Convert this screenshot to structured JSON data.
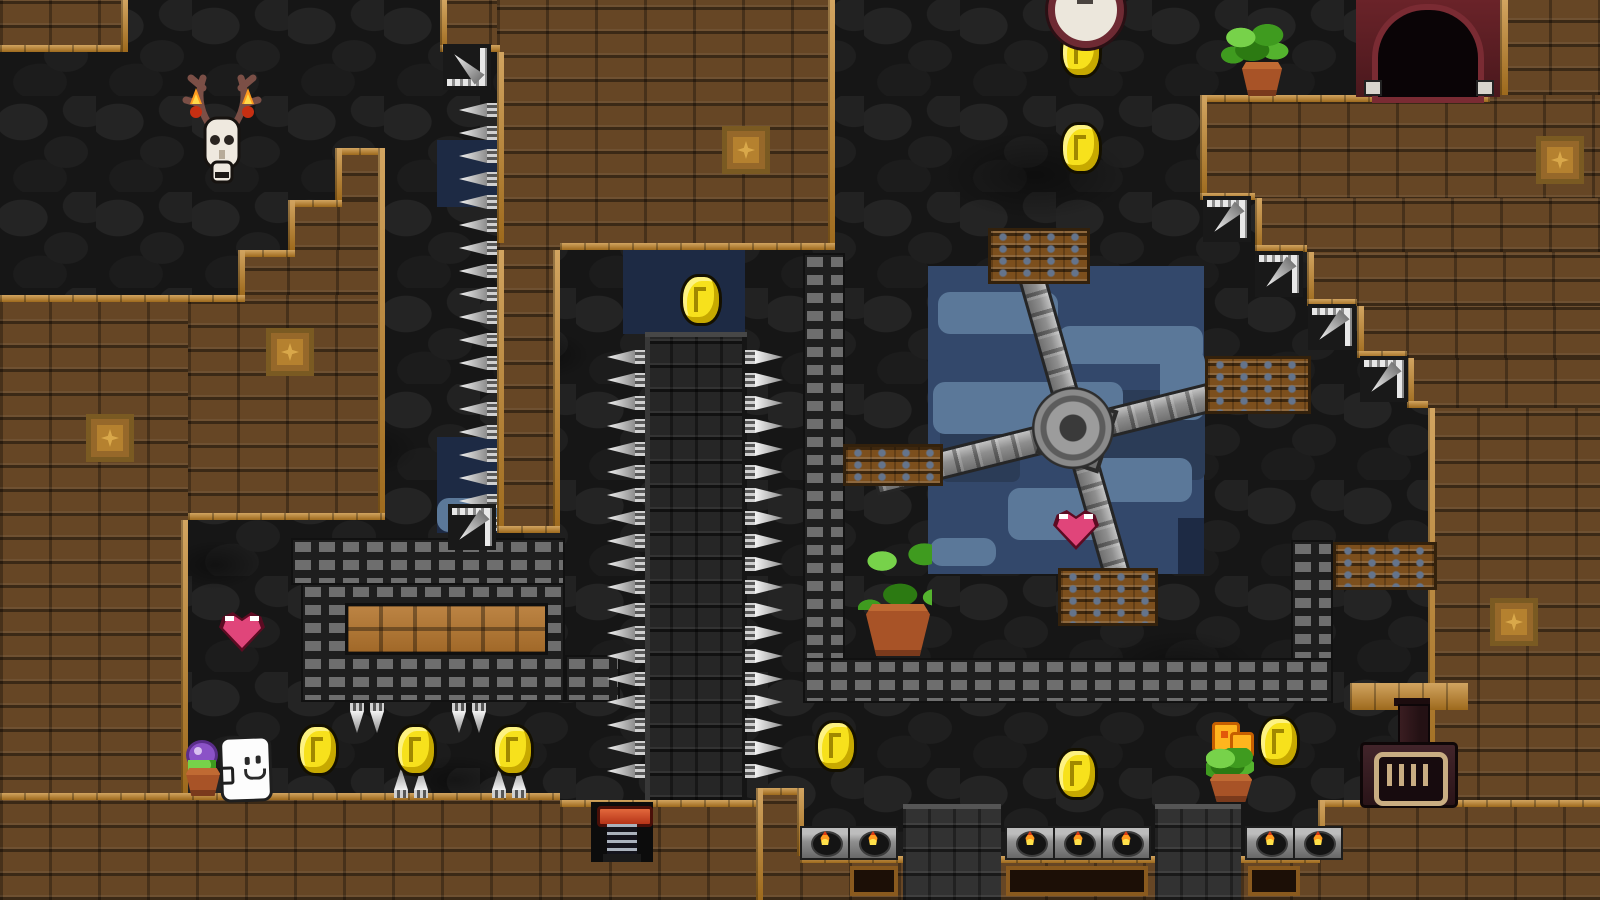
{
  "meta": {
    "description": "Pixel-art platformer cave level screenshot",
    "width": 1600,
    "height": 900,
    "visible_text": ""
  },
  "palette": {
    "cave_bg": "#161616",
    "cave_stone": "#242424",
    "brick_interior": "#664625",
    "brick_edge_orange": "#c08123",
    "water_navy": "#1d2a44",
    "water_slate": "#33486b",
    "cloud_blue": "#5b7899",
    "metal_stud": "#6e6e6e",
    "spike_white": "#f4f4f4",
    "coin_yellow": "#f7e11c",
    "heart_pink": "#e0457a",
    "crate_wood": "#7c4f1d",
    "crate_bolt_blue": "#64748c",
    "flame_orange": "#ff9b1f",
    "flame_yellow": "#ffe14a",
    "pot_terracotta": "#a85327",
    "plant_green": "#3f9b1f",
    "doorway_maroon": "#5d2026",
    "ghost_white": "#fdfdfd"
  },
  "scene": {
    "smudges": [
      [
        110,
        320,
        170,
        90
      ],
      [
        620,
        110,
        130,
        70
      ],
      [
        940,
        130,
        190,
        90
      ],
      [
        290,
        420,
        130,
        60
      ],
      [
        1100,
        630,
        160,
        80
      ],
      [
        400,
        755,
        110,
        50
      ],
      [
        500,
        330,
        90,
        50
      ],
      [
        170,
        540,
        90,
        50
      ]
    ],
    "blue_patches": [
      {
        "r": [
          437,
          140,
          60,
          67
        ],
        "k": "navy"
      },
      {
        "r": [
          437,
          437,
          60,
          96
        ],
        "k": "navy"
      },
      {
        "r": [
          623,
          250,
          122,
          84
        ],
        "k": "navy"
      },
      {
        "r": [
          928,
          266,
          276,
          308
        ],
        "k": "slate"
      },
      {
        "r": [
          1090,
          390,
          115,
          90
        ],
        "k": "deep"
      },
      {
        "r": [
          940,
          420,
          80,
          62
        ],
        "k": "deep"
      },
      {
        "r": [
          1178,
          296,
          26,
          62
        ],
        "k": "slate"
      },
      {
        "r": [
          1178,
          518,
          26,
          56
        ],
        "k": "navy"
      }
    ],
    "clouds": [
      [
        938,
        292,
        120,
        42
      ],
      [
        1058,
        326,
        145,
        38
      ],
      [
        933,
        382,
        190,
        52
      ],
      [
        1092,
        458,
        100,
        44
      ],
      [
        1008,
        488,
        96,
        52
      ],
      [
        930,
        538,
        66,
        28
      ],
      [
        1160,
        350,
        45,
        70
      ],
      [
        437,
        498,
        60,
        34
      ]
    ],
    "bricks": [
      [
        0,
        0,
        128,
        52
      ],
      [
        440,
        0,
        60,
        52
      ],
      [
        497,
        0,
        338,
        250
      ],
      [
        497,
        250,
        63,
        283
      ],
      [
        335,
        148,
        50,
        52
      ],
      [
        288,
        200,
        97,
        50
      ],
      [
        238,
        250,
        147,
        45
      ],
      [
        188,
        295,
        197,
        225
      ],
      [
        0,
        295,
        188,
        605
      ],
      [
        0,
        793,
        560,
        107
      ],
      [
        560,
        800,
        200,
        100
      ],
      [
        756,
        788,
        48,
        112
      ],
      [
        800,
        856,
        520,
        44
      ],
      [
        1318,
        800,
        282,
        100
      ],
      [
        1500,
        0,
        100,
        95
      ],
      [
        1200,
        95,
        400,
        105
      ],
      [
        1255,
        198,
        345,
        54
      ],
      [
        1307,
        252,
        293,
        54
      ],
      [
        1357,
        306,
        243,
        52
      ],
      [
        1407,
        358,
        193,
        50
      ],
      [
        1428,
        408,
        172,
        392
      ]
    ],
    "edges": [
      [
        0,
        45,
        128,
        7
      ],
      [
        121,
        0,
        7,
        52
      ],
      [
        440,
        0,
        7,
        52
      ],
      [
        440,
        45,
        60,
        7
      ],
      [
        828,
        0,
        7,
        250
      ],
      [
        560,
        243,
        275,
        7
      ],
      [
        497,
        52,
        7,
        191
      ],
      [
        497,
        250,
        7,
        283
      ],
      [
        553,
        250,
        7,
        283
      ],
      [
        497,
        526,
        63,
        7
      ],
      [
        335,
        148,
        50,
        7
      ],
      [
        335,
        148,
        7,
        52
      ],
      [
        288,
        200,
        54,
        7
      ],
      [
        288,
        200,
        7,
        50
      ],
      [
        238,
        250,
        57,
        7
      ],
      [
        238,
        250,
        7,
        45
      ],
      [
        188,
        295,
        57,
        7
      ],
      [
        378,
        148,
        7,
        372
      ],
      [
        188,
        513,
        197,
        7
      ],
      [
        0,
        295,
        188,
        7
      ],
      [
        181,
        520,
        7,
        273
      ],
      [
        0,
        793,
        560,
        7
      ],
      [
        560,
        800,
        200,
        7
      ],
      [
        756,
        788,
        48,
        7
      ],
      [
        756,
        788,
        7,
        112
      ],
      [
        797,
        788,
        7,
        68
      ],
      [
        800,
        856,
        520,
        7
      ],
      [
        1318,
        800,
        282,
        7
      ],
      [
        1318,
        800,
        7,
        56
      ],
      [
        1500,
        0,
        8,
        95
      ],
      [
        1200,
        95,
        290,
        7
      ],
      [
        1200,
        95,
        7,
        105
      ],
      [
        1200,
        193,
        55,
        7
      ],
      [
        1255,
        198,
        7,
        54
      ],
      [
        1255,
        245,
        52,
        7
      ],
      [
        1307,
        252,
        7,
        54
      ],
      [
        1307,
        299,
        50,
        7
      ],
      [
        1357,
        306,
        7,
        52
      ],
      [
        1357,
        351,
        50,
        7
      ],
      [
        1407,
        358,
        7,
        50
      ],
      [
        1407,
        401,
        21,
        7
      ],
      [
        1428,
        408,
        7,
        392
      ],
      [
        1350,
        683,
        118,
        27
      ]
    ],
    "decals": [
      [
        722,
        126
      ],
      [
        266,
        328
      ],
      [
        86,
        414
      ],
      [
        1490,
        598
      ],
      [
        1536,
        136
      ]
    ],
    "rails": [
      [
        803,
        253,
        42,
        450
      ],
      [
        803,
        658,
        530,
        45
      ],
      [
        1291,
        540,
        42,
        120
      ],
      [
        291,
        538,
        274,
        47
      ],
      [
        301,
        583,
        264,
        119
      ],
      [
        565,
        655,
        55,
        47
      ]
    ],
    "maze_inset": [
      345,
      603,
      203,
      52
    ],
    "column": [
      645,
      332,
      102,
      468
    ],
    "pillars": [
      [
        903,
        804,
        98,
        96
      ],
      [
        1155,
        804,
        86,
        96
      ]
    ],
    "crates": [
      [
        988,
        228,
        96,
        50
      ],
      [
        1205,
        356,
        100,
        52
      ],
      [
        843,
        444,
        94,
        36
      ],
      [
        1058,
        568,
        94,
        52
      ],
      [
        1333,
        542,
        98,
        42
      ]
    ],
    "drills": [
      {
        "x": 443,
        "y": 44,
        "o": "ul"
      },
      {
        "x": 448,
        "y": 504,
        "o": "dl"
      },
      {
        "x": 1203,
        "y": 196,
        "o": "dl"
      },
      {
        "x": 1255,
        "y": 251,
        "o": "dl"
      },
      {
        "x": 1308,
        "y": 304,
        "o": "dl"
      },
      {
        "x": 1360,
        "y": 356,
        "o": "dl"
      }
    ],
    "spike_rows": [
      {
        "dir": "left",
        "x": 459,
        "y": 103,
        "count": 19,
        "step": 23
      },
      {
        "dir": "left",
        "x": 607,
        "y": 350,
        "count": 19,
        "step": 23
      },
      {
        "dir": "right",
        "x": 745,
        "y": 350,
        "count": 19,
        "step": 23
      },
      {
        "dir": "down",
        "x": 350,
        "y": 703,
        "count": 2,
        "step": 20
      },
      {
        "dir": "down",
        "x": 452,
        "y": 703,
        "count": 2,
        "step": 20
      },
      {
        "dir": "up",
        "x": 394,
        "y": 768,
        "count": 2,
        "step": 20
      },
      {
        "dir": "up",
        "x": 492,
        "y": 768,
        "count": 2,
        "step": 20
      }
    ],
    "fire_blocks": [
      [
        800,
        826
      ],
      [
        848,
        826
      ],
      [
        1005,
        826
      ],
      [
        1053,
        826
      ],
      [
        1101,
        826
      ],
      [
        1245,
        826
      ],
      [
        1293,
        826
      ]
    ],
    "floor_insets": [
      [
        850,
        866,
        48,
        30
      ],
      [
        1006,
        866,
        142,
        30
      ],
      [
        1248,
        866,
        52,
        30
      ]
    ],
    "coins": [
      [
        1060,
        26
      ],
      [
        1060,
        122
      ],
      [
        680,
        274
      ],
      [
        297,
        724
      ],
      [
        395,
        724
      ],
      [
        492,
        724
      ],
      [
        815,
        720
      ],
      [
        1056,
        748
      ],
      [
        1258,
        716
      ]
    ],
    "hearts": [
      [
        219,
        612,
        46,
        40
      ],
      [
        1053,
        510,
        46,
        40
      ]
    ]
  },
  "sprites": {
    "skull": {
      "label": "deer-skull-trophy-with-candles",
      "style": "left:176px;top:62px"
    },
    "clock": {
      "label": "wall-clock",
      "style": "left:1048px;top:-28px"
    },
    "doorway": {
      "label": "dark-exit-doorway",
      "style": "left:1356px;top:0px"
    },
    "fern": {
      "label": "potted-fern",
      "style": "left:1218px;top:20px"
    },
    "bigplant": {
      "label": "potted-plant-large",
      "style": "left:846px;top:514px"
    },
    "orangeflower": {
      "label": "potted-orange-flower",
      "style": "left:1204px;top:722px"
    },
    "purpleflower": {
      "label": "potted-purple-flower",
      "style": "left:186px;top:740px"
    },
    "ghost": {
      "label": "ghost-character",
      "style": "left:220px;top:736px"
    },
    "furnace": {
      "label": "iron-stove-furnace",
      "style": "left:1358px;top:698px"
    },
    "spring": {
      "label": "spring-piston",
      "style": "left:591px;top:802px"
    },
    "windmill": {
      "label": "rotating-cross-obstacle",
      "style": "left:1073px;top:428px"
    }
  }
}
